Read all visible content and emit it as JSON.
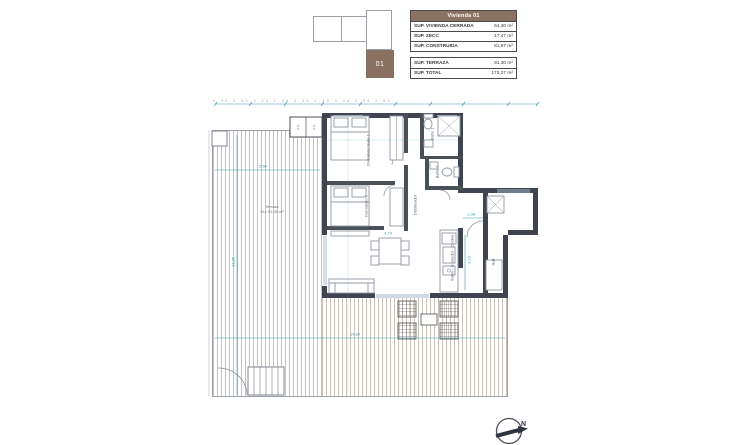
{
  "colors": {
    "accent_brown": "#8a7060",
    "wall_dark": "#3f4450",
    "dimension_teal": "#3f98a8",
    "hatch_line": "#c8c1b8"
  },
  "locator": {
    "unit_label": "01"
  },
  "area_summary": {
    "title": "Vivienda 01",
    "main_rows": [
      {
        "label": "SUP. VIVIENDA CERRADA",
        "value": "64,30 m²"
      },
      {
        "label": "SUP. ZECC",
        "value": "17,47 m²"
      },
      {
        "label": "SUP. CONSTRUIDA",
        "value": "81,97 m²"
      }
    ],
    "total_rows": [
      {
        "label": "SUP. TERRAZA",
        "value": "91,30 m²"
      },
      {
        "label": "SUP. TOTAL",
        "value": "173,27 m²"
      }
    ]
  },
  "plan": {
    "rooms": {
      "suite": "Dormitorio Suite 1",
      "dorm2": "Dormitorio 2",
      "bano1": "Baño 1",
      "bano2": "Baño 2",
      "distribuidor": "Distribuidor",
      "salon": "Salón - Comedor - Cocina",
      "hall": "Hall",
      "terraza": "Terraza",
      "terraza_area": "SU: 91,30 m²"
    },
    "units": {
      "left": "A.A.",
      "right": "A.A."
    },
    "dims": {
      "top_row": "1,20  3,50  3,23  1,08  2,35  1,40  3,05  0,95  2,60",
      "left_height": "13,35",
      "bottom_width": "14,80",
      "terrace_width": "5,50",
      "living_width": "4,74",
      "hall_width": "1,08",
      "kitchen_height": "3,23"
    },
    "north_label": "N"
  }
}
